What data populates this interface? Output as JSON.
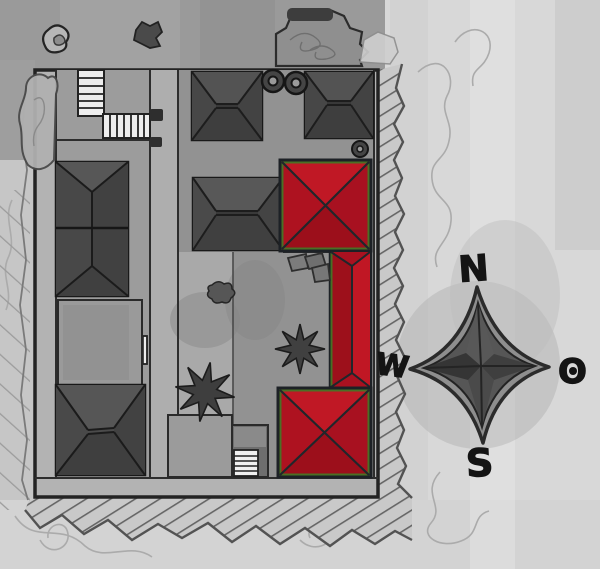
{
  "compass": {
    "north_label": "N",
    "east_label": "O",
    "south_label": "S",
    "west_label": "W"
  },
  "palette": {
    "highlight_red": "#b5131f",
    "highlight_edge_green": "#3f7a26",
    "roof_gray": "#4a4a4a",
    "courtyard_gray": "#929292",
    "paper_gray": "#c7c7c7",
    "paper_light": "#d9d9d9",
    "ink": "#1d1d1d"
  },
  "map": {
    "type": "hand-drawn site plan",
    "highlighted_element_count": 3,
    "features": [
      {
        "id": "north-west-roof",
        "kind": "hip-roof-building",
        "highlighted": false
      },
      {
        "id": "north-east-roof",
        "kind": "hip-roof-building",
        "highlighted": false
      },
      {
        "id": "west-long-hall",
        "kind": "double-hip-roof-building",
        "highlighted": false
      },
      {
        "id": "south-west-roof",
        "kind": "hip-roof-building",
        "highlighted": false
      },
      {
        "id": "central-hall",
        "kind": "hip-roof-building",
        "highlighted": false
      },
      {
        "id": "east-pavilion-north",
        "kind": "pavilion",
        "highlighted": true
      },
      {
        "id": "east-gallery-wing",
        "kind": "wing",
        "highlighted": true
      },
      {
        "id": "east-pavilion-south",
        "kind": "pavilion",
        "highlighted": true
      },
      {
        "id": "round-structures",
        "kind": "circle",
        "count": 3
      },
      {
        "id": "trees",
        "kind": "star-tree",
        "count": 2
      }
    ]
  }
}
